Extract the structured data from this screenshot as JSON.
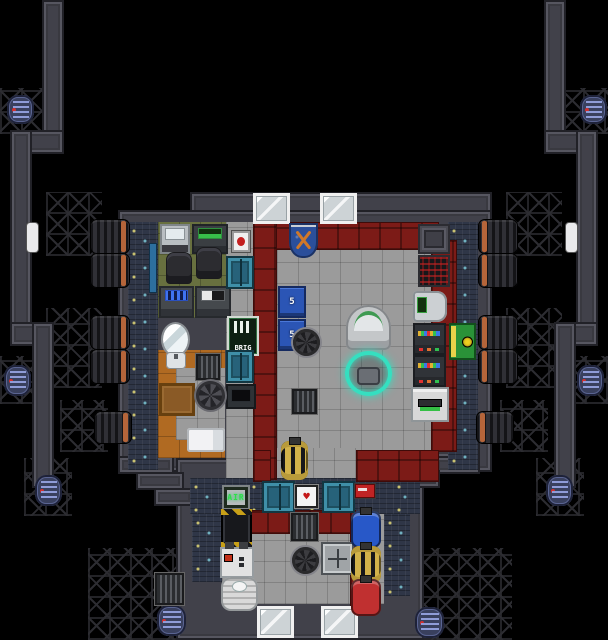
{
  "meta": {
    "game": "space-station-tile-map",
    "view": "top-down brig / security outpost with engine arms"
  },
  "palette": {
    "space": "#000000",
    "hull_wall": "#41414a",
    "brig_wall_red": "#7c1b17",
    "floor_gray": "#9b9b9b",
    "floor_office_green": "#68703f",
    "floor_cell_orange": "#b06a22",
    "plating_blue": "#2f3647",
    "door_teal": "#27627a",
    "sign_green": "#0e1f12",
    "locker_blue": "#2b55b5",
    "rad_locker_green": "#2a9238",
    "canister_blue": "#2858c8",
    "canister_gold": "#d2b24a",
    "canister_red": "#c03030",
    "engine_band_orange": "#b5653a",
    "borg_dock_glow": "#35dfc0"
  },
  "map": {
    "width": 608,
    "height": 640,
    "regions": [
      {
        "name": "lattice-top-left",
        "type": "lattice",
        "x": 0,
        "y": 88,
        "w": 46,
        "h": 46
      },
      {
        "name": "lattice-top-right",
        "type": "lattice",
        "x": 562,
        "y": 88,
        "w": 46,
        "h": 46
      },
      {
        "name": "lattice-mid-left",
        "type": "lattice",
        "x": 0,
        "y": 356,
        "w": 44,
        "h": 48
      },
      {
        "name": "lattice-mid-right",
        "type": "lattice",
        "x": 564,
        "y": 356,
        "w": 44,
        "h": 48
      },
      {
        "name": "lattice-left-engines-upper",
        "type": "lattice",
        "x": 46,
        "y": 192,
        "w": 56,
        "h": 64
      },
      {
        "name": "lattice-left-engines-lower",
        "type": "lattice",
        "x": 46,
        "y": 308,
        "w": 56,
        "h": 80
      },
      {
        "name": "lattice-right-engines-upper",
        "type": "lattice",
        "x": 506,
        "y": 192,
        "w": 56,
        "h": 64
      },
      {
        "name": "lattice-right-engines-lower",
        "type": "lattice",
        "x": 506,
        "y": 308,
        "w": 56,
        "h": 80
      },
      {
        "name": "lattice-left-engine-low",
        "type": "lattice",
        "x": 60,
        "y": 400,
        "w": 48,
        "h": 52
      },
      {
        "name": "lattice-right-engine-low",
        "type": "lattice",
        "x": 500,
        "y": 400,
        "w": 48,
        "h": 52
      },
      {
        "name": "lattice-left-arm-end",
        "type": "lattice",
        "x": 24,
        "y": 458,
        "w": 48,
        "h": 58
      },
      {
        "name": "lattice-right-arm-end",
        "type": "lattice",
        "x": 536,
        "y": 458,
        "w": 48,
        "h": 58
      },
      {
        "name": "lattice-bottom-left",
        "type": "lattice",
        "x": 88,
        "y": 548,
        "w": 104,
        "h": 92
      },
      {
        "name": "lattice-bottom-right",
        "type": "lattice",
        "x": 416,
        "y": 548,
        "w": 96,
        "h": 92
      },
      {
        "name": "arm-left-top",
        "type": "wall",
        "x": 42,
        "y": 0,
        "w": 22,
        "h": 152
      },
      {
        "name": "arm-left-corner",
        "type": "wall",
        "x": 10,
        "y": 130,
        "w": 54,
        "h": 24
      },
      {
        "name": "arm-left-mid",
        "type": "wall",
        "x": 10,
        "y": 130,
        "w": 22,
        "h": 216
      },
      {
        "name": "arm-left-corner2",
        "type": "wall",
        "x": 10,
        "y": 322,
        "w": 44,
        "h": 24
      },
      {
        "name": "arm-left-low",
        "type": "wall",
        "x": 32,
        "y": 322,
        "w": 22,
        "h": 166
      },
      {
        "name": "arm-right-top",
        "type": "wall",
        "x": 544,
        "y": 0,
        "w": 22,
        "h": 152
      },
      {
        "name": "arm-right-corner",
        "type": "wall",
        "x": 544,
        "y": 130,
        "w": 54,
        "h": 24
      },
      {
        "name": "arm-right-mid",
        "type": "wall",
        "x": 576,
        "y": 130,
        "w": 22,
        "h": 216
      },
      {
        "name": "arm-right-corner2",
        "type": "wall",
        "x": 554,
        "y": 322,
        "w": 44,
        "h": 24
      },
      {
        "name": "arm-right-low",
        "type": "wall",
        "x": 554,
        "y": 322,
        "w": 22,
        "h": 166
      },
      {
        "name": "hull-top-wall",
        "type": "wall",
        "x": 190,
        "y": 192,
        "w": 302,
        "h": 34
      },
      {
        "name": "hull-main",
        "type": "wall",
        "x": 118,
        "y": 210,
        "w": 374,
        "h": 262
      },
      {
        "name": "hull-south",
        "type": "wall",
        "x": 176,
        "y": 458,
        "w": 248,
        "h": 182
      },
      {
        "name": "hull-sw-step1",
        "type": "wall",
        "x": 118,
        "y": 456,
        "w": 56,
        "h": 18
      },
      {
        "name": "hull-sw-step2",
        "type": "wall",
        "x": 136,
        "y": 472,
        "w": 48,
        "h": 18
      },
      {
        "name": "hull-sw-step3",
        "type": "wall",
        "x": 154,
        "y": 488,
        "w": 40,
        "h": 18
      },
      {
        "name": "hull-se-step1",
        "type": "wall",
        "x": 424,
        "y": 440,
        "w": 56,
        "h": 18
      },
      {
        "name": "hull-se-step2",
        "type": "wall",
        "x": 434,
        "y": 456,
        "w": 46,
        "h": 18
      },
      {
        "name": "hull-se-step3",
        "type": "wall",
        "x": 400,
        "y": 470,
        "w": 40,
        "h": 18
      },
      {
        "name": "floor-office",
        "type": "floor-office",
        "x": 158,
        "y": 222,
        "w": 68,
        "h": 96
      },
      {
        "name": "floor-corridor-mid",
        "type": "floor-gray",
        "x": 226,
        "y": 222,
        "w": 28,
        "h": 258
      },
      {
        "name": "floor-cell",
        "type": "floor-orange",
        "x": 158,
        "y": 350,
        "w": 67,
        "h": 108
      },
      {
        "name": "floor-cell-inner",
        "type": "floor-gray",
        "x": 176,
        "y": 368,
        "w": 49,
        "h": 72
      },
      {
        "name": "floor-main-room",
        "type": "floor-gray",
        "x": 277,
        "y": 248,
        "w": 154,
        "h": 204
      },
      {
        "name": "floor-main-south-opening",
        "type": "floor-gray",
        "x": 271,
        "y": 448,
        "w": 85,
        "h": 34
      },
      {
        "name": "plating-west",
        "type": "plating",
        "x": 128,
        "y": 222,
        "w": 30,
        "h": 248
      },
      {
        "name": "plating-east",
        "type": "plating",
        "x": 448,
        "y": 222,
        "w": 30,
        "h": 248
      },
      {
        "name": "plating-corridor-south",
        "type": "plating",
        "x": 190,
        "y": 478,
        "w": 230,
        "h": 36
      },
      {
        "name": "floor-atmos",
        "type": "floor-gray",
        "x": 222,
        "y": 514,
        "w": 162,
        "h": 90
      },
      {
        "name": "plating-south-west",
        "type": "plating",
        "x": 192,
        "y": 514,
        "w": 30,
        "h": 68
      },
      {
        "name": "plating-south-east",
        "type": "plating",
        "x": 384,
        "y": 514,
        "w": 26,
        "h": 82
      },
      {
        "name": "brig-wall-north",
        "type": "wall-red",
        "x": 253,
        "y": 222,
        "w": 186,
        "h": 28
      },
      {
        "name": "brig-wall-west",
        "type": "wall-red",
        "x": 253,
        "y": 222,
        "w": 24,
        "h": 258
      },
      {
        "name": "brig-wall-east",
        "type": "wall-red",
        "x": 431,
        "y": 240,
        "w": 26,
        "h": 212
      },
      {
        "name": "brig-wall-south-left",
        "type": "wall-red",
        "x": 253,
        "y": 450,
        "w": 18,
        "h": 32
      },
      {
        "name": "brig-wall-south-right",
        "type": "wall-red",
        "x": 356,
        "y": 450,
        "w": 83,
        "h": 32
      },
      {
        "name": "atmos-wall-north-red",
        "type": "wall-red",
        "x": 246,
        "y": 510,
        "w": 110,
        "h": 24
      },
      {
        "name": "atmos-wall-east-red",
        "type": "wall-red",
        "x": 350,
        "y": 512,
        "w": 8,
        "h": 94
      },
      {
        "name": "window-north-1",
        "type": "window",
        "x": 253,
        "y": 193,
        "w": 37,
        "h": 31
      },
      {
        "name": "window-north-2",
        "type": "window",
        "x": 320,
        "y": 193,
        "w": 37,
        "h": 31
      },
      {
        "name": "window-south-1",
        "type": "window",
        "x": 257,
        "y": 606,
        "w": 37,
        "h": 32
      },
      {
        "name": "window-south-2",
        "type": "window",
        "x": 321,
        "y": 606,
        "w": 37,
        "h": 32
      },
      {
        "name": "wall-bolted-plate",
        "type": "wall-plate",
        "x": 418,
        "y": 224,
        "w": 32,
        "h": 30
      },
      {
        "name": "heat-vent-machine",
        "type": "machine-redgrid",
        "x": 418,
        "y": 255,
        "w": 32,
        "h": 32
      }
    ],
    "objects": [
      {
        "name": "camera-monitor-console",
        "type": "console-white",
        "x": 160,
        "y": 224,
        "w": 30,
        "h": 30
      },
      {
        "name": "security-console",
        "type": "console-green",
        "x": 192,
        "y": 224,
        "w": 36,
        "h": 30
      },
      {
        "name": "office-intercom",
        "type": "wallbox-red",
        "x": 232,
        "y": 231,
        "w": 18,
        "h": 21
      },
      {
        "name": "office-chair-1",
        "type": "chair",
        "x": 167,
        "y": 253,
        "w": 24,
        "h": 30
      },
      {
        "name": "office-chair-2",
        "type": "chair",
        "x": 197,
        "y": 248,
        "w": 24,
        "h": 30
      },
      {
        "name": "records-console",
        "type": "console-blue",
        "x": 159,
        "y": 286,
        "w": 35,
        "h": 32
      },
      {
        "name": "id-console",
        "type": "console-id",
        "x": 195,
        "y": 286,
        "w": 36,
        "h": 32
      },
      {
        "name": "airlock-office",
        "type": "door-blue",
        "x": 226,
        "y": 256,
        "w": 28,
        "h": 33
      },
      {
        "name": "brig-sign",
        "type": "sign-brig",
        "x": 229,
        "y": 318,
        "w": 28,
        "h": 36,
        "label": "BRIG"
      },
      {
        "name": "airlock-cell-corridor",
        "type": "door-blue",
        "x": 226,
        "y": 350,
        "w": 28,
        "h": 33
      },
      {
        "name": "prisoner-console",
        "type": "console-dark",
        "x": 226,
        "y": 384,
        "w": 30,
        "h": 25
      },
      {
        "name": "cell-mirror",
        "type": "mirror",
        "x": 163,
        "y": 324,
        "w": 25,
        "h": 31
      },
      {
        "name": "cell-sink",
        "type": "sink",
        "x": 166,
        "y": 352,
        "w": 20,
        "h": 17
      },
      {
        "name": "cell-window-grille",
        "type": "vent-grille",
        "x": 196,
        "y": 354,
        "w": 24,
        "h": 26
      },
      {
        "name": "cell-wood-table",
        "type": "table-wood",
        "x": 159,
        "y": 383,
        "w": 36,
        "h": 33
      },
      {
        "name": "cell-fan-vent",
        "type": "fan",
        "x": 196,
        "y": 381,
        "w": 29,
        "h": 29
      },
      {
        "name": "cell-bed",
        "type": "bed",
        "x": 187,
        "y": 428,
        "w": 38,
        "h": 24
      },
      {
        "name": "wall-flag",
        "type": "flag",
        "x": 289,
        "y": 223,
        "w": 29,
        "h": 35
      },
      {
        "name": "security-locker-1",
        "type": "locker-blue",
        "x": 278,
        "y": 286,
        "w": 28,
        "h": 32,
        "label": "5"
      },
      {
        "name": "security-locker-2",
        "type": "locker-blue",
        "x": 278,
        "y": 319,
        "w": 28,
        "h": 32,
        "label": "5"
      },
      {
        "name": "floor-drain-main",
        "type": "drain",
        "x": 293,
        "y": 329,
        "w": 27,
        "h": 27
      },
      {
        "name": "floor-vent-main",
        "type": "vent-grille",
        "x": 292,
        "y": 389,
        "w": 25,
        "h": 25
      },
      {
        "name": "recharge-station",
        "type": "dome",
        "x": 346,
        "y": 305,
        "w": 45,
        "h": 45
      },
      {
        "name": "cyborg-dock",
        "type": "borg-dock",
        "x": 345,
        "y": 351,
        "w": 47,
        "h": 45
      },
      {
        "name": "canister-tuned-brig",
        "type": "canister-gold",
        "x": 281,
        "y": 441,
        "w": 27,
        "h": 39
      },
      {
        "name": "helm-console-chair",
        "type": "console-chair",
        "x": 413,
        "y": 291,
        "w": 34,
        "h": 31
      },
      {
        "name": "comms-server-1",
        "type": "server",
        "x": 413,
        "y": 323,
        "w": 33,
        "h": 32
      },
      {
        "name": "comms-server-2",
        "type": "server",
        "x": 413,
        "y": 355,
        "w": 33,
        "h": 32
      },
      {
        "name": "fax-machine",
        "type": "machine-white",
        "x": 411,
        "y": 387,
        "w": 38,
        "h": 35
      },
      {
        "name": "radiation-closet",
        "type": "locker-green",
        "x": 449,
        "y": 323,
        "w": 27,
        "h": 37
      },
      {
        "name": "airlock-brig-west",
        "type": "door-blue",
        "x": 262,
        "y": 481,
        "w": 33,
        "h": 32
      },
      {
        "name": "airlock-brig-east",
        "type": "door-blue",
        "x": 322,
        "y": 481,
        "w": 33,
        "h": 32
      },
      {
        "name": "defib-mount",
        "type": "wallbox-heart",
        "x": 295,
        "y": 485,
        "w": 23,
        "h": 23
      },
      {
        "name": "south-intercom",
        "type": "wallbox-redsmall",
        "x": 355,
        "y": 484,
        "w": 20,
        "h": 14
      },
      {
        "name": "air-dispenser",
        "type": "machine-air",
        "x": 222,
        "y": 485,
        "w": 28,
        "h": 25,
        "label": "AIR"
      },
      {
        "name": "smes-battery",
        "type": "smes",
        "x": 221,
        "y": 509,
        "w": 31,
        "h": 39
      },
      {
        "name": "portable-pump",
        "type": "machine-gauges",
        "x": 220,
        "y": 547,
        "w": 34,
        "h": 31
      },
      {
        "name": "space-heater",
        "type": "heater",
        "x": 221,
        "y": 577,
        "w": 37,
        "h": 34
      },
      {
        "name": "atmos-grille",
        "type": "vent-grille",
        "x": 291,
        "y": 513,
        "w": 27,
        "h": 28
      },
      {
        "name": "atmos-drain",
        "type": "drain",
        "x": 292,
        "y": 547,
        "w": 27,
        "h": 27
      },
      {
        "name": "flow-control-box",
        "type": "machine-arrows",
        "x": 321,
        "y": 542,
        "w": 33,
        "h": 33
      },
      {
        "name": "canister-blue",
        "type": "canister-blue",
        "x": 351,
        "y": 511,
        "w": 30,
        "h": 37
      },
      {
        "name": "canister-tuned",
        "type": "canister-gold",
        "x": 351,
        "y": 546,
        "w": 30,
        "h": 37
      },
      {
        "name": "canister-red",
        "type": "canister-red",
        "x": 351,
        "y": 579,
        "w": 30,
        "h": 37
      },
      {
        "name": "engine-left-1",
        "type": "engine-left",
        "x": 90,
        "y": 219,
        "w": 40,
        "h": 35
      },
      {
        "name": "engine-left-2",
        "type": "engine-left",
        "x": 90,
        "y": 253,
        "w": 40,
        "h": 35
      },
      {
        "name": "engine-left-3",
        "type": "engine-left",
        "x": 90,
        "y": 315,
        "w": 40,
        "h": 35
      },
      {
        "name": "engine-left-4",
        "type": "engine-left",
        "x": 90,
        "y": 349,
        "w": 40,
        "h": 35
      },
      {
        "name": "engine-left-5",
        "type": "engine-left",
        "x": 94,
        "y": 411,
        "w": 38,
        "h": 33
      },
      {
        "name": "engine-right-1",
        "type": "engine-right",
        "x": 478,
        "y": 219,
        "w": 40,
        "h": 35
      },
      {
        "name": "engine-right-2",
        "type": "engine-right",
        "x": 478,
        "y": 253,
        "w": 40,
        "h": 35
      },
      {
        "name": "engine-right-3",
        "type": "engine-right",
        "x": 478,
        "y": 315,
        "w": 40,
        "h": 35
      },
      {
        "name": "engine-right-4",
        "type": "engine-right",
        "x": 478,
        "y": 349,
        "w": 40,
        "h": 35
      },
      {
        "name": "engine-right-5",
        "type": "engine-right",
        "x": 476,
        "y": 411,
        "w": 38,
        "h": 33
      },
      {
        "name": "satellite-top-left",
        "type": "satellite",
        "x": 7,
        "y": 95,
        "w": 27,
        "h": 29
      },
      {
        "name": "satellite-top-right",
        "type": "satellite",
        "x": 580,
        "y": 95,
        "w": 27,
        "h": 29
      },
      {
        "name": "satellite-mid-left",
        "type": "satellite",
        "x": 4,
        "y": 365,
        "w": 27,
        "h": 31
      },
      {
        "name": "satellite-mid-right",
        "type": "satellite",
        "x": 577,
        "y": 365,
        "w": 27,
        "h": 31
      },
      {
        "name": "satellite-arm-left",
        "type": "satellite",
        "x": 35,
        "y": 475,
        "w": 27,
        "h": 31
      },
      {
        "name": "satellite-arm-right",
        "type": "satellite",
        "x": 546,
        "y": 475,
        "w": 27,
        "h": 31
      },
      {
        "name": "satellite-bottom-left",
        "type": "satellite",
        "x": 157,
        "y": 605,
        "w": 29,
        "h": 31
      },
      {
        "name": "satellite-bottom-right",
        "type": "satellite",
        "x": 415,
        "y": 607,
        "w": 29,
        "h": 31
      },
      {
        "name": "space-grille",
        "type": "vent-grille",
        "x": 155,
        "y": 573,
        "w": 29,
        "h": 32
      },
      {
        "name": "debris-left",
        "type": "debris",
        "x": 27,
        "y": 223,
        "w": 11,
        "h": 29
      },
      {
        "name": "debris-right",
        "type": "debris",
        "x": 566,
        "y": 223,
        "w": 11,
        "h": 29
      },
      {
        "name": "office-wall-pipe",
        "type": "wallpipe",
        "x": 149,
        "y": 243,
        "w": 8,
        "h": 50
      }
    ]
  }
}
